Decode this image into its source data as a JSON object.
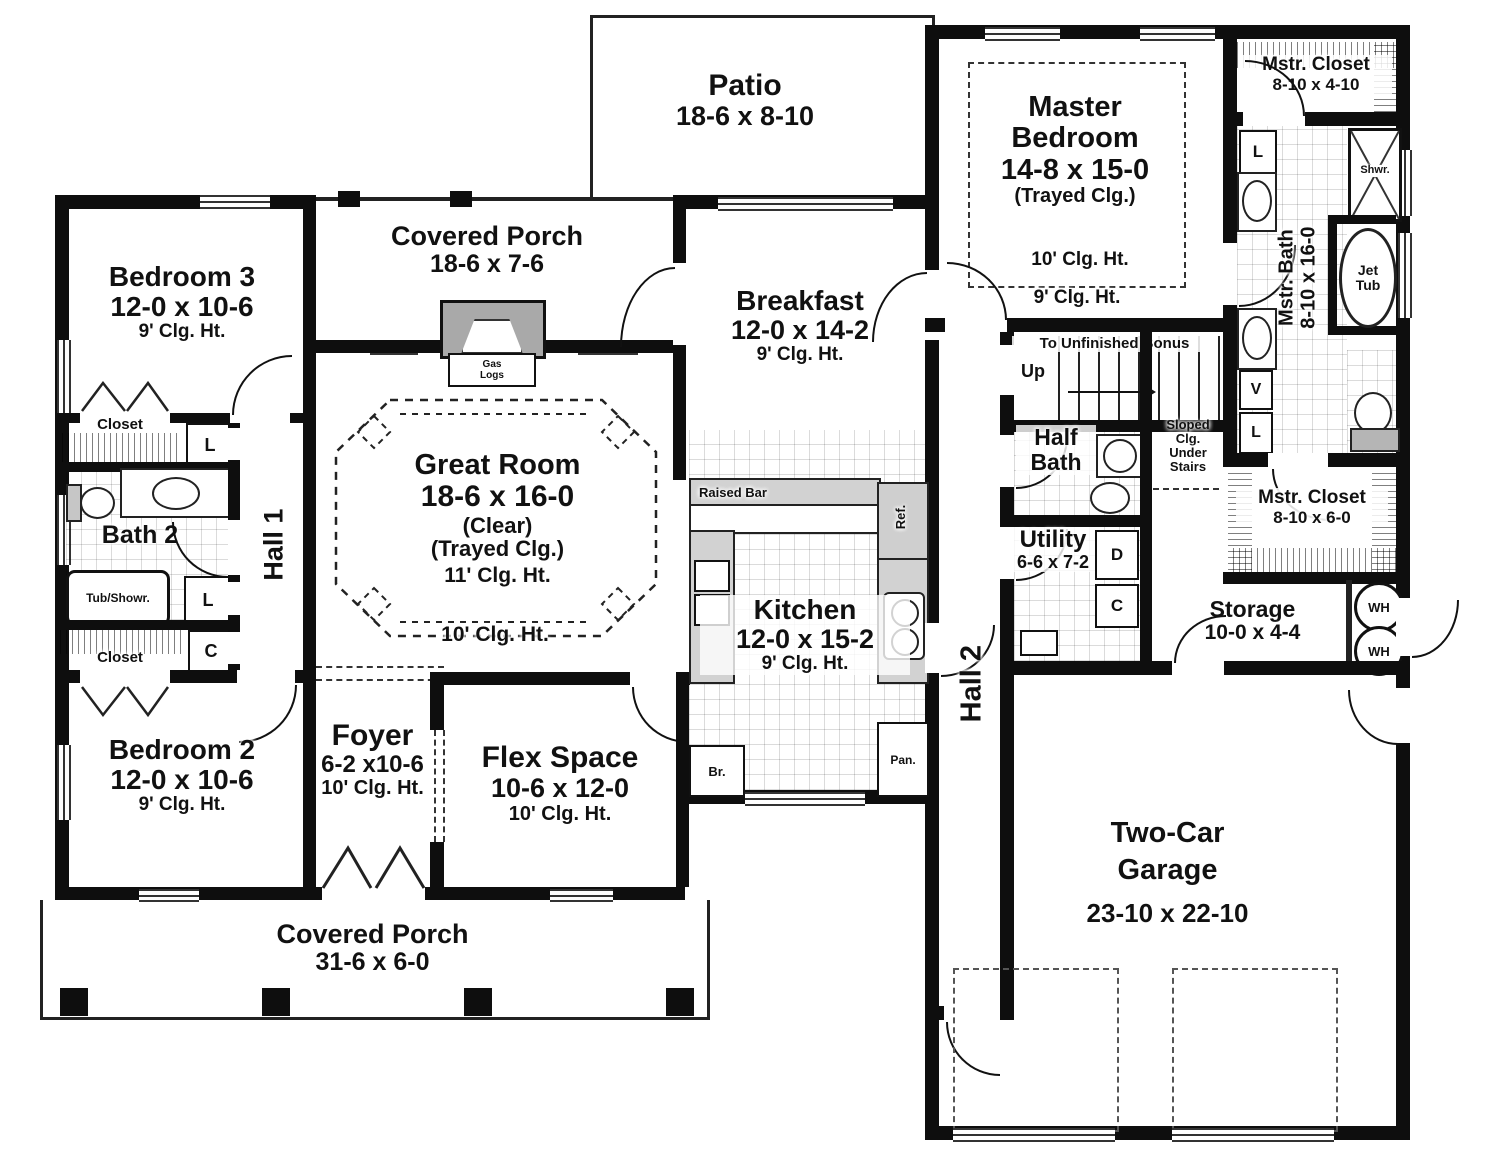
{
  "rooms": {
    "patio": {
      "name": "Patio",
      "size": "18-6 x 8-10"
    },
    "covered_porch_top": {
      "name": "Covered Porch",
      "size": "18-6 x 7-6"
    },
    "bedroom3": {
      "name": "Bedroom 3",
      "size": "12-0 x 10-6",
      "ceiling": "9' Clg. Ht."
    },
    "master_bedroom": {
      "line1": "Master",
      "line2": "Bedroom",
      "size": "14-8 x 15-0",
      "note": "(Trayed Clg.)",
      "ceiling_inner": "10' Clg. Ht.",
      "ceiling_outer": "9' Clg. Ht."
    },
    "mstr_closet_top": {
      "name": "Mstr. Closet",
      "size": "8-10 x 4-10"
    },
    "breakfast": {
      "name": "Breakfast",
      "size": "12-0 x 14-2",
      "ceiling": "9' Clg. Ht."
    },
    "great_room": {
      "name": "Great Room",
      "size": "18-6 x 16-0",
      "note1": "(Clear)",
      "note2": "(Trayed Clg.)",
      "ceiling_inner": "11' Clg. Ht.",
      "ceiling_outer": "10' Clg. Ht."
    },
    "mstr_bath": {
      "name": "Mstr. Bath",
      "size": "8-10 x 16-0"
    },
    "hall1": {
      "name": "Hall 1"
    },
    "hall2": {
      "name": "Hall 2"
    },
    "bath2": {
      "name": "Bath 2"
    },
    "half_bath": {
      "line1": "Half",
      "line2": "Bath"
    },
    "utility": {
      "name": "Utility",
      "size": "6-6 x 7-2"
    },
    "kitchen": {
      "name": "Kitchen",
      "size": "12-0 x 15-2",
      "ceiling": "9' Clg. Ht."
    },
    "mstr_closet_lower": {
      "name": "Mstr. Closet",
      "size": "8-10 x 6-0"
    },
    "storage": {
      "name": "Storage",
      "size": "10-0 x 4-4"
    },
    "bedroom2": {
      "name": "Bedroom 2",
      "size": "12-0 x 10-6",
      "ceiling": "9' Clg. Ht."
    },
    "foyer": {
      "name": "Foyer",
      "size": "6-2 x10-6",
      "ceiling": "10' Clg. Ht."
    },
    "flex_space": {
      "name": "Flex Space",
      "size": "10-6 x 12-0",
      "ceiling": "10' Clg. Ht."
    },
    "garage": {
      "line1": "Two-Car",
      "line2": "Garage",
      "size": "23-10 x 22-10"
    },
    "covered_porch_bottom": {
      "name": "Covered Porch",
      "size": "31-6 x 6-0"
    }
  },
  "fixtures": {
    "gas_logs_line1": "Gas",
    "gas_logs_line2": "Logs",
    "raised_bar": "Raised Bar",
    "ref": "Ref.",
    "pantry": "Pan.",
    "broom": "Br.",
    "tub_shower": "Tub/Showr.",
    "shower": "Shwr.",
    "jet_tub_line1": "Jet",
    "jet_tub_line2": "Tub",
    "water_heater": "WH",
    "closet": "Closet",
    "linen": "L",
    "coat": "C",
    "vanity": "V",
    "dryer": "D",
    "stairs_note": "To Unfinished Bonus",
    "up": "Up",
    "sloped_line1": "Sloped",
    "sloped_line2": "Clg.",
    "sloped_line3": "Under",
    "sloped_line4": "Stairs"
  }
}
